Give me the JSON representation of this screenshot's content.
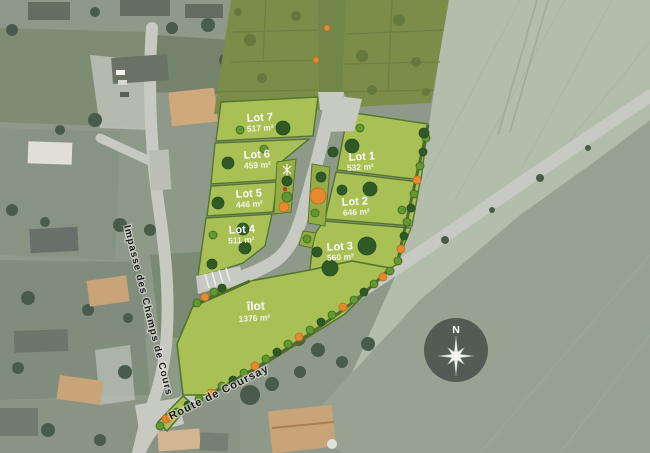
{
  "colors": {
    "lot_fill": "#a9c055",
    "lot_border": "#55752e",
    "reserve_fill": "#7b8d49",
    "road_gray": "#c7cac2",
    "tree_dark": "#2f5a26",
    "tree_light": "#63982f",
    "shrub_orange": "#e8892e",
    "label_white": "#ffffff",
    "street_text": "#1e1e1e",
    "field_pale": "#b2bdab",
    "field_dark": "#96a392",
    "aerial_base": "#8f998a",
    "roof_tan": "#c9a478",
    "roof_dark": "#656c60",
    "compass_bg": "#3f4742"
  },
  "plan": {
    "lots": [
      {
        "name": "Lot 1",
        "area": "532 m²"
      },
      {
        "name": "Lot 2",
        "area": "646 m²"
      },
      {
        "name": "Lot 3",
        "area": "560 m²"
      },
      {
        "name": "Lot 4",
        "area": "511 m²"
      },
      {
        "name": "Lot 5",
        "area": "446 m²"
      },
      {
        "name": "Lot 6",
        "area": "459 m²"
      },
      {
        "name": "Lot 7",
        "area": "517 m²"
      }
    ],
    "ilot": {
      "name": "îlot",
      "area": "1376 m²"
    }
  },
  "streets": {
    "impasse": "Impasse des Champs de Cours",
    "route": "Route de Coursay"
  },
  "compass": {
    "north": "N"
  }
}
